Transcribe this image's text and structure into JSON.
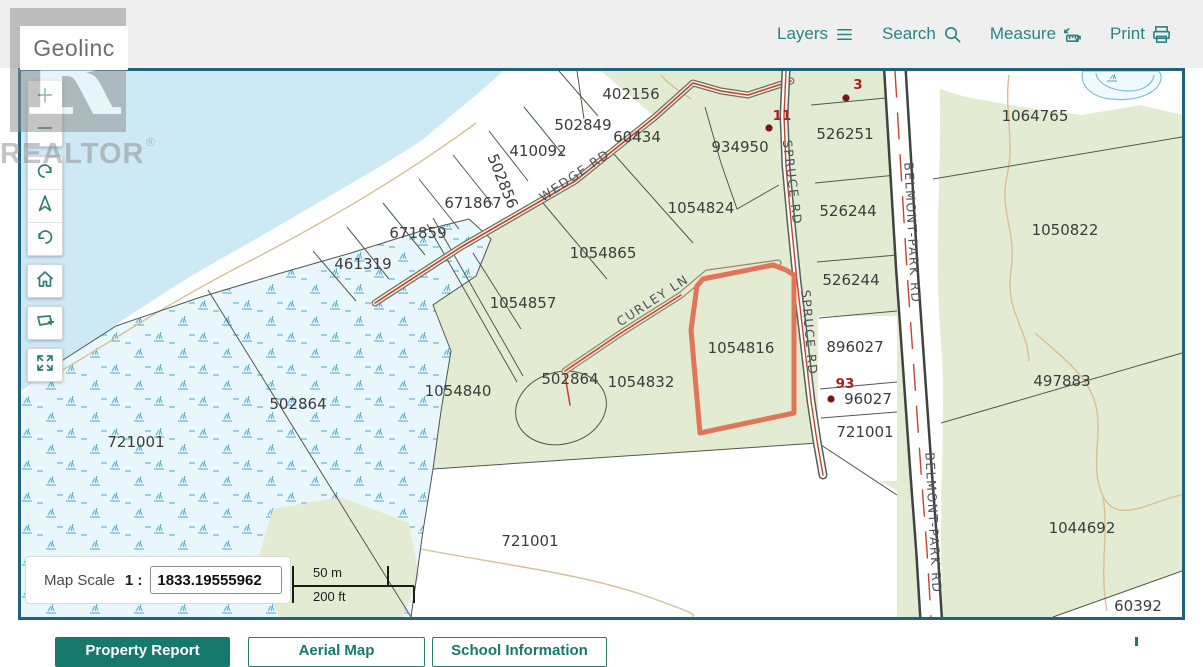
{
  "header": {
    "logo": "Geolinc",
    "nav": [
      {
        "name": "layers",
        "label": "Layers",
        "icon": "layers-icon"
      },
      {
        "name": "search",
        "label": "Search",
        "icon": "search-icon"
      },
      {
        "name": "measure",
        "label": "Measure",
        "icon": "measure-icon"
      },
      {
        "name": "print",
        "label": "Print",
        "icon": "print-icon"
      }
    ]
  },
  "watermark": {
    "letter": "R",
    "text": "REALTOR®"
  },
  "toolbar": {
    "buttons": [
      {
        "name": "zoom-in",
        "icon": "plus-icon"
      },
      {
        "name": "zoom-out",
        "icon": "minus-icon"
      },
      {
        "name": "rotate-cw",
        "icon": "rotate-cw-icon"
      },
      {
        "name": "compass",
        "icon": "compass-icon"
      },
      {
        "name": "rotate-ccw",
        "icon": "rotate-ccw-icon"
      },
      {
        "name": "home",
        "icon": "home-icon"
      },
      {
        "name": "select-extent",
        "icon": "box-plus-icon"
      },
      {
        "name": "fullscreen",
        "icon": "expand-icon"
      }
    ]
  },
  "map": {
    "selected_parcel": "1054816",
    "parcel_labels": [
      {
        "text": "402156",
        "x": 610,
        "y": 28
      },
      {
        "text": "502849",
        "x": 562,
        "y": 59
      },
      {
        "text": "60434",
        "x": 616,
        "y": 71
      },
      {
        "text": "410092",
        "x": 517,
        "y": 85
      },
      {
        "text": "502856",
        "x": 477,
        "y": 112,
        "rot": 68
      },
      {
        "text": "671867",
        "x": 452,
        "y": 137
      },
      {
        "text": "671859",
        "x": 397,
        "y": 167
      },
      {
        "text": "461319",
        "x": 342,
        "y": 198
      },
      {
        "text": "934950",
        "x": 719,
        "y": 81
      },
      {
        "text": "1054824",
        "x": 680,
        "y": 142
      },
      {
        "text": "526251",
        "x": 824,
        "y": 68
      },
      {
        "text": "526244",
        "x": 827,
        "y": 145
      },
      {
        "text": "526244",
        "x": 830,
        "y": 214
      },
      {
        "text": "1064765",
        "x": 1014,
        "y": 50
      },
      {
        "text": "1050822",
        "x": 1044,
        "y": 164
      },
      {
        "text": "1054865",
        "x": 582,
        "y": 187
      },
      {
        "text": "1054857",
        "x": 502,
        "y": 237
      },
      {
        "text": "1054840",
        "x": 437,
        "y": 325
      },
      {
        "text": "502864",
        "x": 277,
        "y": 338
      },
      {
        "text": "721001",
        "x": 115,
        "y": 376
      },
      {
        "text": "502864",
        "x": 549,
        "y": 313
      },
      {
        "text": "1054832",
        "x": 620,
        "y": 316
      },
      {
        "text": "1054816",
        "x": 720,
        "y": 282
      },
      {
        "text": "896027",
        "x": 834,
        "y": 281
      },
      {
        "text": "721001",
        "x": 844,
        "y": 366
      },
      {
        "text": "497883",
        "x": 1041,
        "y": 315
      },
      {
        "text": "1044692",
        "x": 1061,
        "y": 462
      },
      {
        "text": "60392",
        "x": 1117,
        "y": 540
      },
      {
        "text": "721001",
        "x": 509,
        "y": 475
      }
    ],
    "road_labels": [
      {
        "text": "WEDGE RD",
        "x": 556,
        "y": 108,
        "rot": -34
      },
      {
        "text": "CURLEY LN",
        "x": 634,
        "y": 233,
        "rot": -33
      },
      {
        "text": "SPRUCE RD",
        "x": 767,
        "y": 112,
        "rot": 83
      },
      {
        "text": "SPRUCE RD",
        "x": 784,
        "y": 262,
        "rot": 85
      },
      {
        "text": "BELMONT-PARK RD",
        "x": 887,
        "y": 162,
        "rot": 87
      },
      {
        "text": "BELMONT-PARK RD",
        "x": 908,
        "y": 452,
        "rot": 87
      }
    ],
    "civic_labels": [
      {
        "text": "11",
        "x": 761,
        "y": 49
      },
      {
        "text": "3",
        "x": 837,
        "y": 18
      },
      {
        "text": "93",
        "x": 824,
        "y": 317
      }
    ],
    "address_labels": [
      {
        "text": "96027",
        "x": 847,
        "y": 333
      }
    ],
    "dots": [
      {
        "x": 748,
        "y": 57
      },
      {
        "x": 825,
        "y": 27
      },
      {
        "x": 810,
        "y": 328
      }
    ],
    "colors": {
      "water": "#cde9f5",
      "land": "#e3ecd3",
      "wetland": "#e9f6fb",
      "highlight": "#e0755a",
      "road_center": "#c7432e",
      "civic": "#a3231d",
      "border": "#20627a",
      "accent": "#2a8385",
      "button": "#17796d"
    }
  },
  "scale_control": {
    "label": "Map Scale",
    "ratio": "1 :",
    "value": "1833.19555962",
    "bar_top": "50 m",
    "bar_bottom": "200 ft"
  },
  "footer": {
    "buttons": [
      {
        "name": "property-report",
        "label": "Property Report",
        "style": "solid",
        "left": 55,
        "width": 175
      },
      {
        "name": "aerial-map",
        "label": "Aerial Map",
        "style": "outline",
        "left": 248,
        "width": 177
      },
      {
        "name": "school-information",
        "label": "School Information",
        "style": "outline",
        "left": 432,
        "width": 175
      }
    ]
  }
}
